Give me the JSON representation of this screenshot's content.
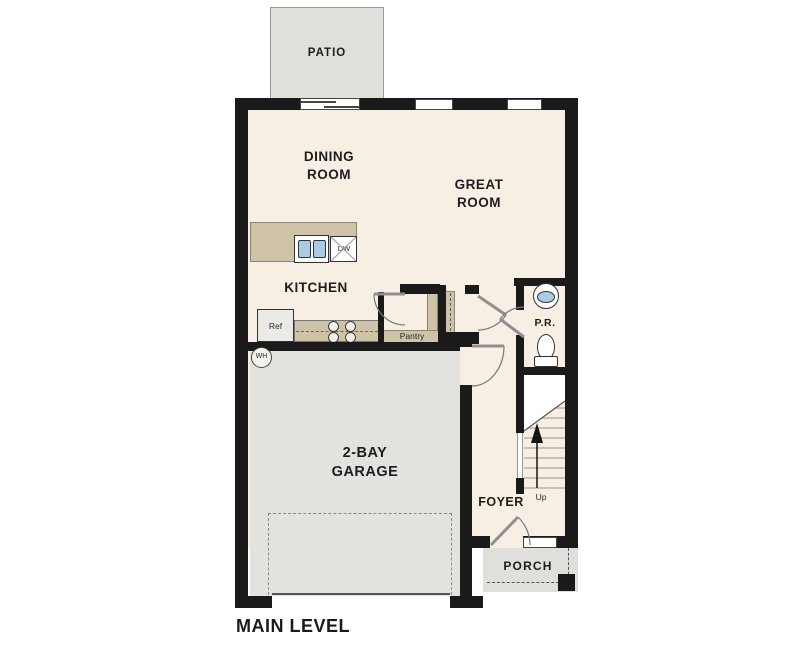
{
  "plan": {
    "title": "MAIN LEVEL",
    "rooms": {
      "patio": "PATIO",
      "dining": "DINING\nROOM",
      "great": "GREAT\nROOM",
      "kitchen": "KITCHEN",
      "garage": "2-BAY\nGARAGE",
      "foyer": "FOYER",
      "powder": "P.R.",
      "porch": "PORCH"
    },
    "annotations": {
      "pantry": "Pantry",
      "up": "Up",
      "ref": "Ref",
      "dw": "DW",
      "wh": "WH"
    },
    "colors": {
      "wall": "#1a1a1a",
      "floor": "#f7efe3",
      "counter": "#cfc3a7",
      "garage": "#e4e2df",
      "outdoor": "#e0dfdc",
      "sink": "#a9cbe5",
      "text": "#1d1d1d",
      "line": "#6b6b6b"
    }
  }
}
